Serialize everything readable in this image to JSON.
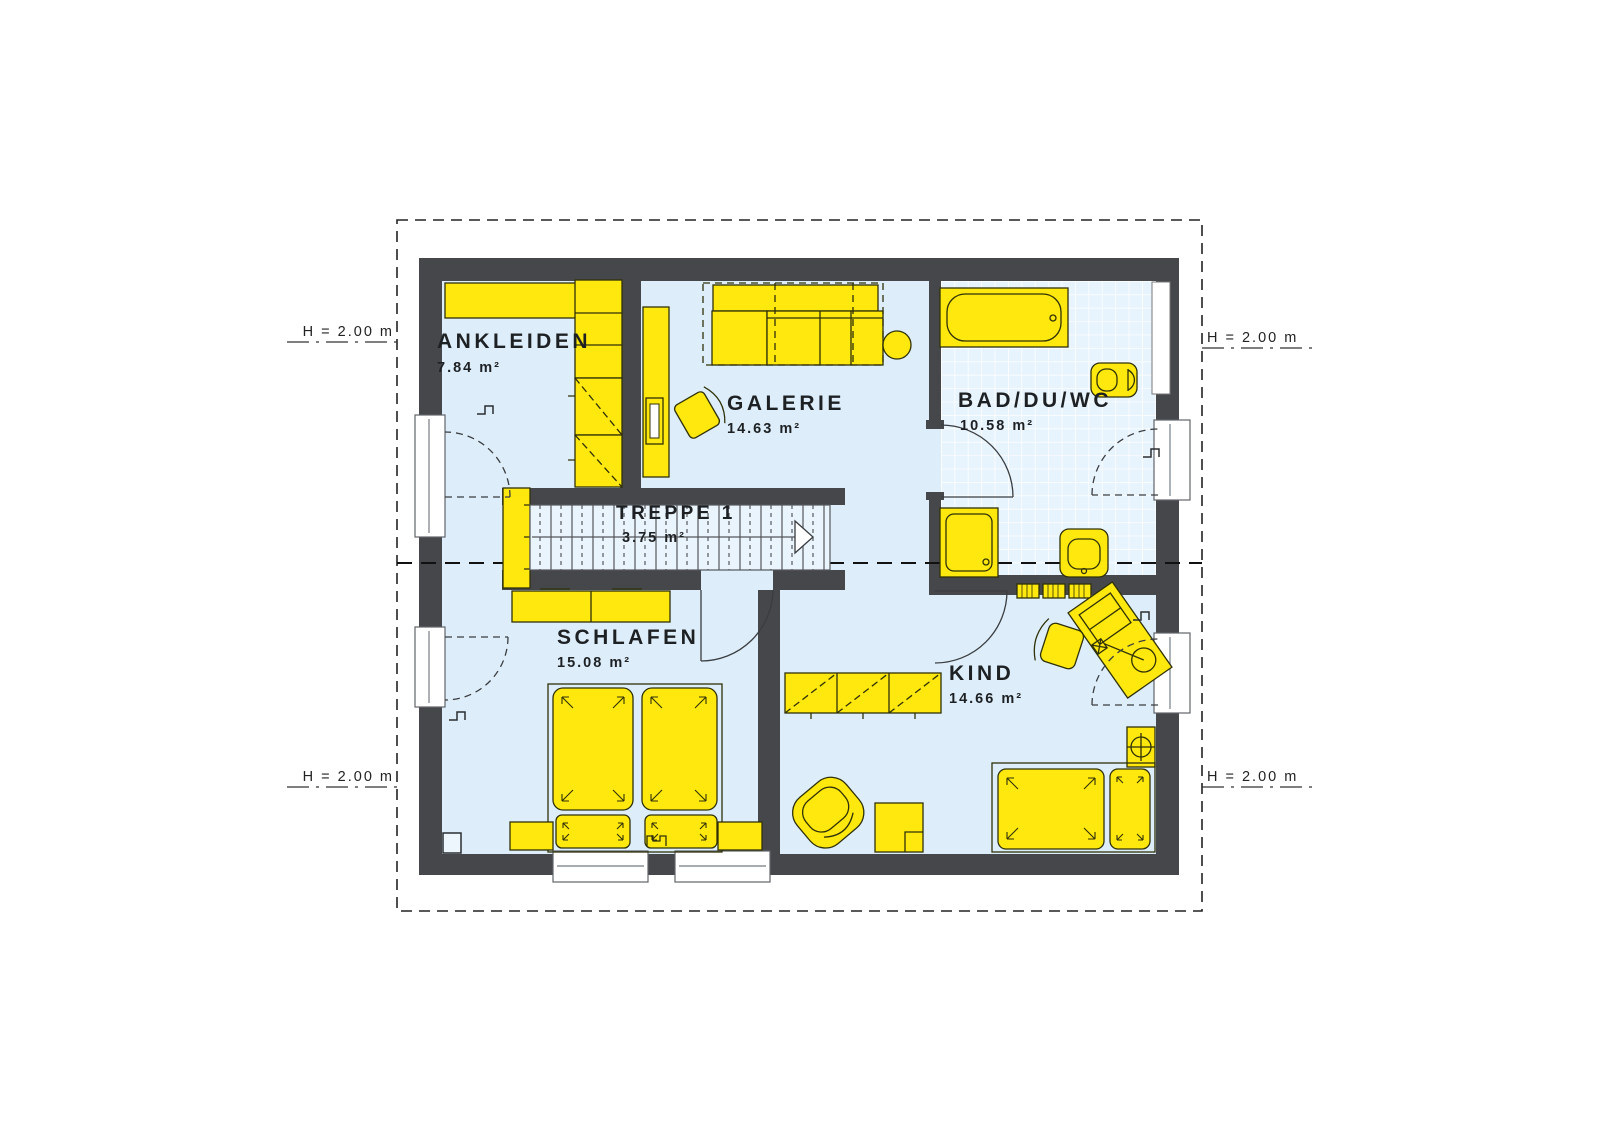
{
  "plan": {
    "height_marker": "H = 2.00 m",
    "rooms": [
      {
        "name": "ANKLEIDEN",
        "area": "7.84 m²"
      },
      {
        "name": "GALERIE",
        "area": "14.63 m²"
      },
      {
        "name": "BAD/DU/WC",
        "area": "10.58 m²"
      },
      {
        "name": "TREPPE 1",
        "area": "3.75 m²"
      },
      {
        "name": "SCHLAFEN",
        "area": "15.08 m²"
      },
      {
        "name": "KIND",
        "area": "14.66 m²"
      }
    ],
    "colors": {
      "wall": "#46474b",
      "floor": "#ddeefa",
      "furniture": "#ffe80d",
      "tile_line": "#ffffff"
    }
  }
}
